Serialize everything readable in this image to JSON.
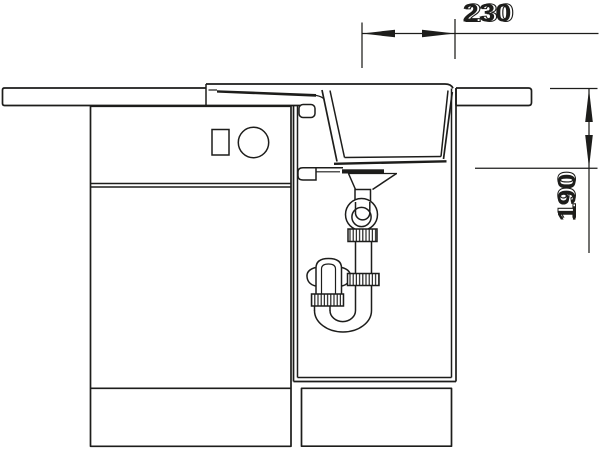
{
  "canvas": {
    "width_px": 600,
    "height_px": 450,
    "background_color": "#ffffff",
    "line_color": "#1d1d1b"
  },
  "dimensions": {
    "width": {
      "label": "230"
    },
    "depth": {
      "label": "190"
    }
  }
}
